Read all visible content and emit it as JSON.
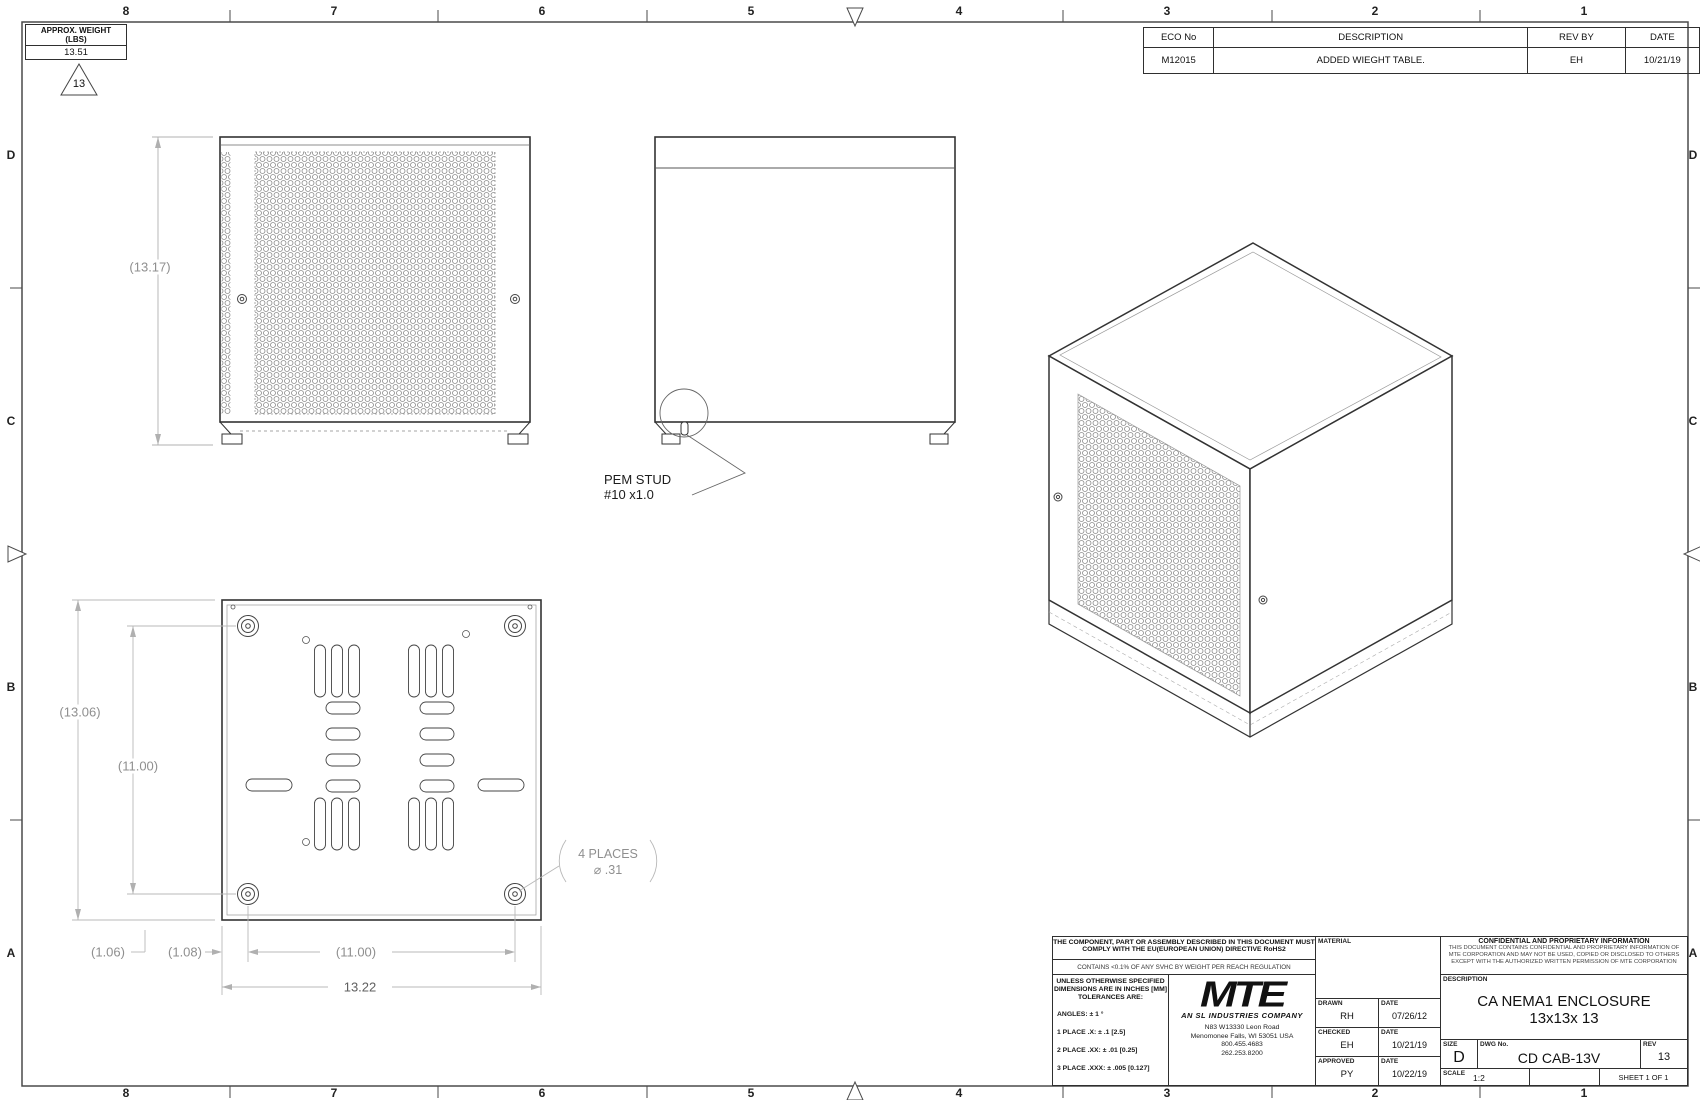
{
  "sheet": {
    "zones_top": [
      "8",
      "7",
      "6",
      "5",
      "4",
      "3",
      "2",
      "1"
    ],
    "zones_bottom": [
      "8",
      "7",
      "6",
      "5",
      "4",
      "3",
      "2",
      "1"
    ],
    "zones_left": [
      "D",
      "C",
      "B",
      "A"
    ],
    "zones_right": [
      "D",
      "C",
      "B",
      "A"
    ]
  },
  "weight_table": {
    "header": "APPROX. WEIGHT\n(LBS)",
    "value": "13.51",
    "revision_flag": "13"
  },
  "eco_table": {
    "col_eco": "ECO No",
    "col_desc": "DESCRIPTION",
    "col_rev": "REV BY",
    "col_date": "DATE",
    "row_eco": "M12015",
    "row_desc": "ADDED WIEGHT TABLE.",
    "row_rev": "EH",
    "row_date": "10/21/19"
  },
  "front_view": {
    "height_dim": "(13.17)"
  },
  "side_view": {
    "callout_line1": "PEM STUD",
    "callout_line2": "#10 x1.0"
  },
  "bottom_view": {
    "overall_height": "(13.06)",
    "inner_height": "(11.00)",
    "offset_a": "(1.06)",
    "offset_b": "(1.08)",
    "inner_width": "(11.00)",
    "overall_width": "13.22",
    "holes_note": "4 PLACES",
    "holes_dia": "⌀ .31"
  },
  "compliance": {
    "rohs": "THE COMPONENT, PART OR ASSEMBLY DESCRIBED IN THIS DOCUMENT MUST COMPLY WITH THE EU(EUROPEAN UNION) DIRECTIVE RoHS2",
    "reach": "CONTAINS <0.1% OF ANY SVHC BY WEIGHT PER REACH REGULATION"
  },
  "tolerances": {
    "heading": "UNLESS OTHERWISE SPECIFIED\nDIMENSIONS ARE IN INCHES [MM]\nTOLERANCES ARE:",
    "angles": "ANGLES: ± 1 °",
    "place1": "1 PLACE .X:  ± .1 [2.5]",
    "place2": "2 PLACE .XX:  ± .01 [0.25]",
    "place3": "3 PLACE .XXX:  ± .005 [0.127]"
  },
  "company": {
    "logo": "MTE",
    "tagline": "AN SL INDUSTRIES COMPANY",
    "address1": "N83 W13330 Leon Road",
    "address2": "Menomonee Falls, WI 53051 USA",
    "phone1": "800.455.4683",
    "phone2": "262.253.8200"
  },
  "title_block": {
    "material_label": "MATERIAL",
    "drawn_label": "DRAWN",
    "drawn_by": "RH",
    "drawn_date_label": "DATE",
    "drawn_date": "07/26/12",
    "checked_label": "CHECKED",
    "checked_by": "EH",
    "checked_date_label": "DATE",
    "checked_date": "10/21/19",
    "approved_label": "APPROVED",
    "approved_by": "PY",
    "approved_date_label": "DATE",
    "approved_date": "10/22/19",
    "confidential_title": "CONFIDENTIAL AND PROPRIETARY INFORMATION",
    "confidential_body": "THIS DOCUMENT CONTAINS CONFIDENTIAL AND PROPRIETARY INFORMATION OF MTE CORPORATION AND MAY NOT BE USED, COPIED OR DISCLOSED TO OTHERS EXCEPT WITH THE AUTHORIZED WRITTEN PERMISSION OF MTE CORPORATION",
    "description_label": "DESCRIPTION",
    "description": "CA NEMA1 ENCLOSURE 13x13x 13",
    "size_label": "SIZE",
    "size": "D",
    "dwg_label": "DWG No.",
    "dwg_no": "CD CAB-13V",
    "rev_label": "REV",
    "rev": "13",
    "scale_label": "SCALE",
    "scale": "1:2",
    "sheet_label": "SHEET 1  OF 1"
  }
}
